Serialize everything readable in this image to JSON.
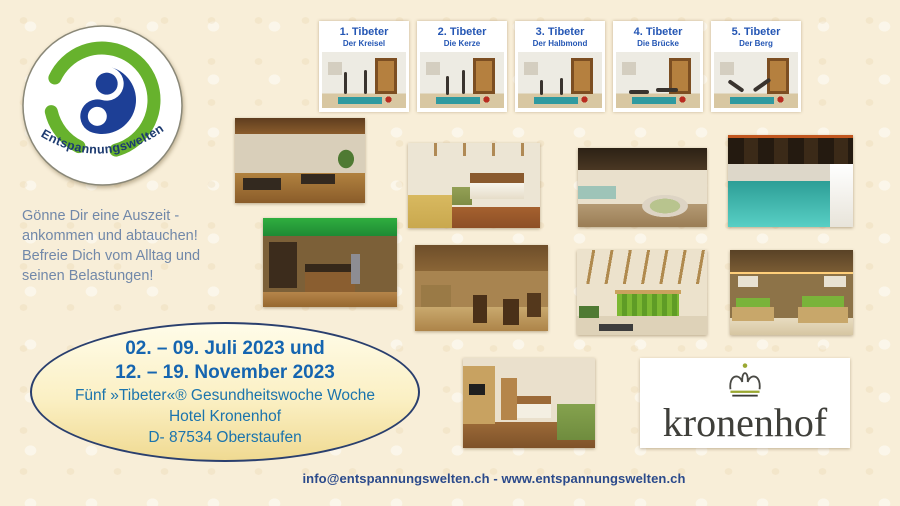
{
  "brand": {
    "logo_text": "Entspannungswelten"
  },
  "exercises": [
    {
      "label": "1.  Tibeter",
      "subtitle": "Der Kreisel"
    },
    {
      "label": "2. Tibeter",
      "subtitle": "Die Kerze"
    },
    {
      "label": "3. Tibeter",
      "subtitle": "Der Halbmond"
    },
    {
      "label": "4. Tibeter",
      "subtitle": "Die Brücke"
    },
    {
      "label": "5. Tibeter",
      "subtitle": "Der Berg"
    }
  ],
  "intro": {
    "lines": [
      "Gönne Dir eine Auszeit -",
      "ankommen und abtauchen!",
      "Befreie Dich vom Alltag und",
      "seinen Belastungen!"
    ]
  },
  "offer": {
    "dates_line1": "02. – 09. Juli 2023 und",
    "dates_line2": "12. – 19. November 2023",
    "program": "Fünf »Tibeter«® Gesundheitswoche Woche",
    "hotel": "Hotel Kronenhof",
    "address": "D- 87534 Oberstaufen"
  },
  "hotel_logo": {
    "name": "kronenhof"
  },
  "footer": {
    "contact": "info@entspannungswelten.ch - www.entspannungswelten.ch"
  },
  "colors": {
    "background": "#f8eed8",
    "caption_blue": "#2456b4",
    "dates_blue": "#1565b0",
    "program_blue": "#1b74ad",
    "intro_slate": "#7188a9",
    "footer_blue": "#2b4a8b",
    "logo_green": "#67b22d",
    "logo_blue": "#1d3f96",
    "oval_border": "#2a3f6e"
  }
}
